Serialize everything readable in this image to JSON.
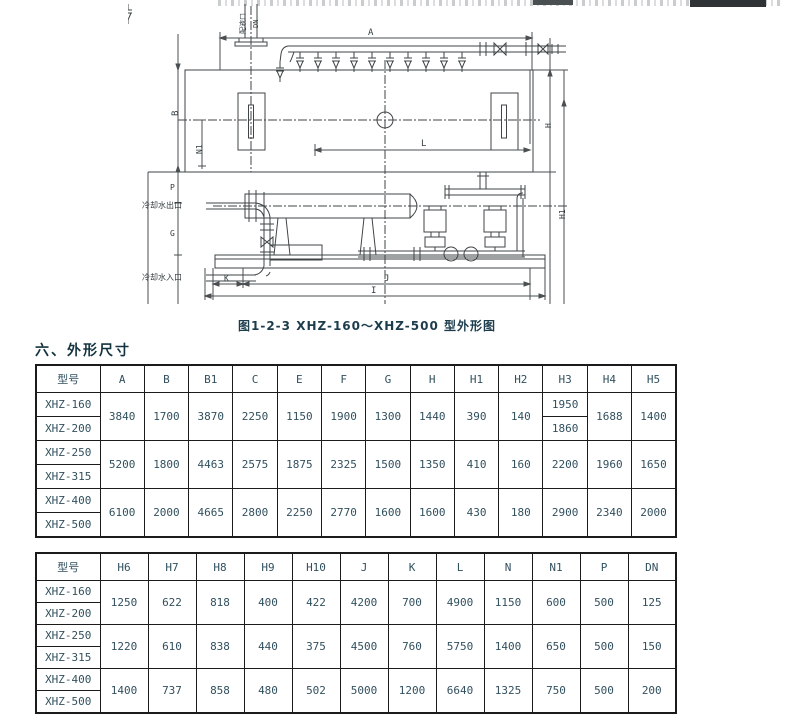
{
  "page": {
    "caption": "图1-2-3 XHZ-160～XHZ-500 型外形图",
    "section_heading": "六、外形尺寸"
  },
  "diagram": {
    "annotations": {
      "feed_port": "配液口",
      "feed_port_size": "DN",
      "cooling_water_outlet": "冷却水出口",
      "cooling_water_inlet": "冷却水入口"
    },
    "dims": {
      "a": "A",
      "b": "B",
      "n1": "N1",
      "l": "L",
      "p": "P",
      "g": "G",
      "k": "K",
      "j": "J",
      "i": "I",
      "h_right": "H",
      "h1_right": "H1"
    }
  },
  "table1": {
    "headers": [
      "型号",
      "A",
      "B",
      "B1",
      "C",
      "E",
      "F",
      "G",
      "H",
      "H1",
      "H2",
      "H3",
      "H4",
      "H5"
    ],
    "groups": [
      {
        "models": [
          "XHZ-160",
          "XHZ-200"
        ],
        "values": [
          "3840",
          "1700",
          "3870",
          "2250",
          "1150",
          "1900",
          "1300",
          "1440",
          "390",
          "140",
          [
            "1950",
            "1860"
          ],
          "1688",
          "1400"
        ]
      },
      {
        "models": [
          "XHZ-250",
          "XHZ-315"
        ],
        "values": [
          "5200",
          "1800",
          "4463",
          "2575",
          "1875",
          "2325",
          "1500",
          "1350",
          "410",
          "160",
          "2200",
          "1960",
          "1650"
        ]
      },
      {
        "models": [
          "XHZ-400",
          "XHZ-500"
        ],
        "values": [
          "6100",
          "2000",
          "4665",
          "2800",
          "2250",
          "2770",
          "1600",
          "1600",
          "430",
          "180",
          "2900",
          "2340",
          "2000"
        ]
      }
    ]
  },
  "table2": {
    "headers": [
      "型号",
      "H6",
      "H7",
      "H8",
      "H9",
      "H10",
      "J",
      "K",
      "L",
      "N",
      "N1",
      "P",
      "DN"
    ],
    "groups": [
      {
        "models": [
          "XHZ-160",
          "XHZ-200"
        ],
        "values": [
          "1250",
          "622",
          "818",
          "400",
          "422",
          "4200",
          "700",
          "4900",
          "1150",
          "600",
          "500",
          "125"
        ]
      },
      {
        "models": [
          "XHZ-250",
          "XHZ-315"
        ],
        "values": [
          "1220",
          "610",
          "838",
          "440",
          "375",
          "4500",
          "760",
          "5750",
          "1400",
          "650",
          "500",
          "150"
        ]
      },
      {
        "models": [
          "XHZ-400",
          "XHZ-500"
        ],
        "values": [
          "1400",
          "737",
          "858",
          "480",
          "502",
          "5000",
          "1200",
          "6640",
          "1325",
          "750",
          "500",
          "200"
        ]
      }
    ]
  },
  "colors": {
    "line": "#3f4446",
    "text": "#31505e",
    "heading": "#13323f",
    "border": "#1b1b1b"
  }
}
